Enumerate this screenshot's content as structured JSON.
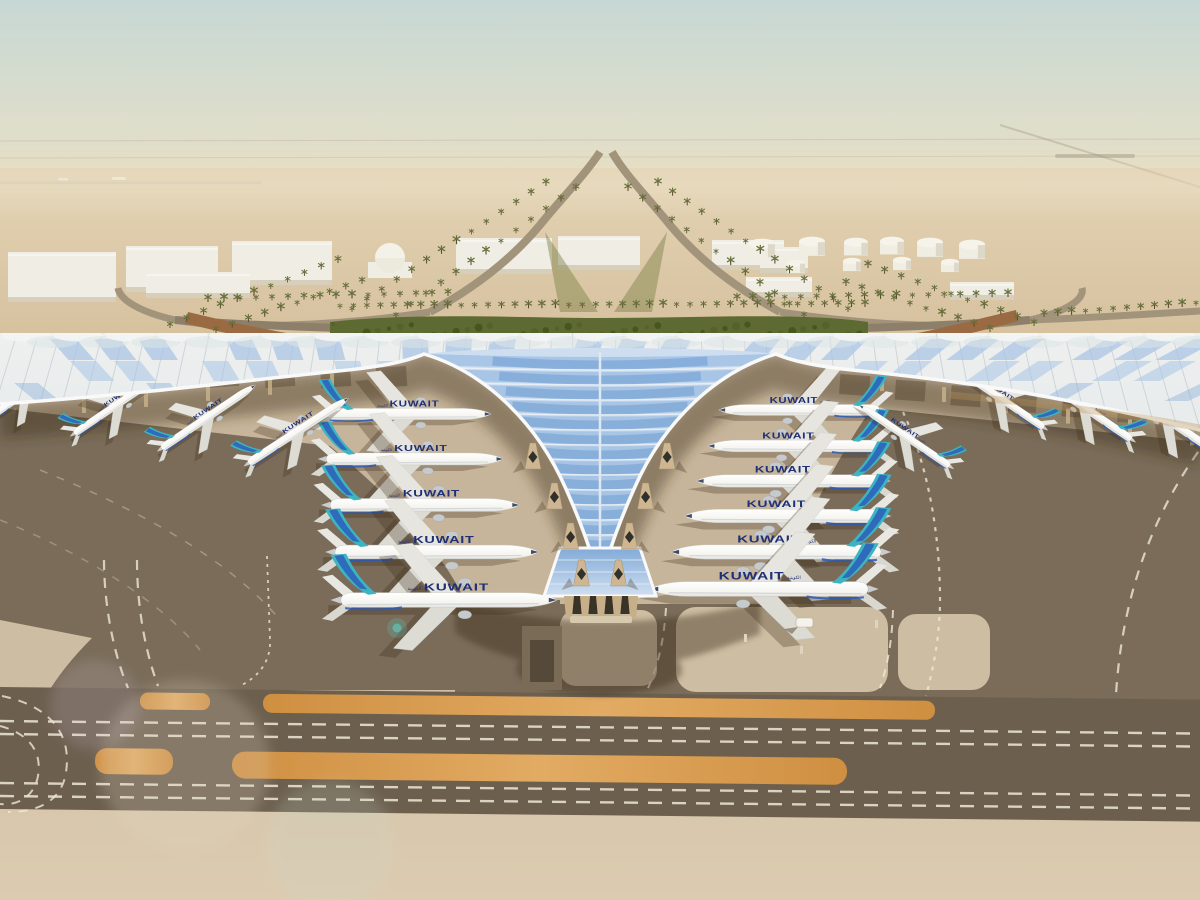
{
  "scene_title": "Aerial rendering of Kuwait International Airport terminal with Kuwait Airways aircraft parked at gates",
  "livery": {
    "title": "KUWAIT",
    "script": "الكويتية"
  },
  "counts": {
    "widebodies_left_pier": 5,
    "widebodies_right_pier": 6,
    "narrowbodies_wings": 7,
    "storage_tanks": 10
  },
  "colors": {
    "sky_top": "#c7d8d4",
    "sky_mid": "#dfdecb",
    "horizon": "#e9dcbf",
    "desert_far": "#e3d3b4",
    "desert_near": "#d5bf9c",
    "haze": "#ece0c6",
    "building": "#efede4",
    "building_shade": "#d6cfbc",
    "tank": "#f0ede2",
    "road": "#a2937b",
    "road_dark": "#8d7f6a",
    "ramp_wall": "#9a6a42",
    "palm": "#65703a",
    "hedge": "#5d6a31",
    "hedge_dark": "#47551f",
    "roof_light": "#eef0ef",
    "roof_shade": "#dde3e6",
    "roof_rib": "#c6ced3",
    "fascia": "#f8f9f8",
    "glass": "#a7c4e5",
    "glass_deep": "#82aad8",
    "glass_pale": "#cfdff0",
    "shadow": "#3e2f1c",
    "apron": "#c7b59b",
    "apron_dark": "#b2a086",
    "asphalt": "#7a6c59",
    "asphalt_dark": "#6c5f4e",
    "island": "#cdbda2",
    "orange1": "#cf8f41",
    "orange2": "#e2ab63",
    "marking": "#efe8d6",
    "concrete": "#d3c3a8",
    "concrete_light": "#dccbb0",
    "fuselage": "#f5f4f0",
    "belly": "#cfd3d6",
    "teal": "#3db4c2",
    "navy": "#2b59b8",
    "title_navy": "#1e3076",
    "column_tan": "#c7b089",
    "pod_tan": "#cdb691"
  },
  "aircraft": {
    "left_pier": [
      {
        "x": 408,
        "y": 414,
        "s": 0.8,
        "rot": 0
      },
      {
        "x": 414,
        "y": 459,
        "s": 0.86,
        "rot": 0
      },
      {
        "x": 424,
        "y": 505,
        "s": 0.92,
        "rot": 0
      },
      {
        "x": 436,
        "y": 552,
        "s": 0.99,
        "rot": 0
      },
      {
        "x": 448,
        "y": 600,
        "s": 1.05,
        "rot": 0
      }
    ],
    "right_pier": [
      {
        "x": 800,
        "y": 410,
        "s": 0.78,
        "rot": 0
      },
      {
        "x": 795,
        "y": 446,
        "s": 0.84,
        "rot": 0
      },
      {
        "x": 790,
        "y": 481,
        "s": 0.9,
        "rot": 0
      },
      {
        "x": 784,
        "y": 516,
        "s": 0.96,
        "rot": 0
      },
      {
        "x": 777,
        "y": 552,
        "s": 1.02,
        "rot": 0
      },
      {
        "x": 760,
        "y": 589,
        "s": 1.06,
        "rot": 0
      }
    ],
    "left_wing": [
      {
        "x": 25,
        "y": 393,
        "s": 0.5,
        "rot": -35
      },
      {
        "x": 118,
        "y": 404,
        "s": 0.52,
        "rot": -34
      },
      {
        "x": 208,
        "y": 417,
        "s": 0.55,
        "rot": -34
      },
      {
        "x": 298,
        "y": 431,
        "s": 0.58,
        "rot": -33
      }
    ],
    "right_wing": [
      {
        "x": 905,
        "y": 436,
        "s": 0.53,
        "rot": 34
      },
      {
        "x": 1000,
        "y": 398,
        "s": 0.52,
        "rot": 34
      },
      {
        "x": 1085,
        "y": 408,
        "s": 0.55,
        "rot": 34
      },
      {
        "x": 1168,
        "y": 420,
        "s": 0.57,
        "rot": 34
      }
    ]
  },
  "palm_rows": [
    {
      "x1": 340,
      "y1": 309,
      "x2": 865,
      "y2": 307,
      "n": 40
    },
    {
      "x1": 352,
      "y1": 312,
      "x2": 546,
      "y2": 186,
      "n": 14
    },
    {
      "x1": 396,
      "y1": 318,
      "x2": 576,
      "y2": 191,
      "n": 13
    },
    {
      "x1": 848,
      "y1": 312,
      "x2": 658,
      "y2": 186,
      "n": 14
    },
    {
      "x1": 804,
      "y1": 318,
      "x2": 628,
      "y2": 191,
      "n": 13
    },
    {
      "x1": 170,
      "y1": 328,
      "x2": 338,
      "y2": 263,
      "n": 11
    },
    {
      "x1": 216,
      "y1": 333,
      "x2": 362,
      "y2": 284,
      "n": 10
    },
    {
      "x1": 1034,
      "y1": 326,
      "x2": 868,
      "y2": 268,
      "n": 11
    },
    {
      "x1": 990,
      "y1": 332,
      "x2": 846,
      "y2": 286,
      "n": 10
    },
    {
      "x1": 1044,
      "y1": 317,
      "x2": 1196,
      "y2": 306,
      "n": 12
    },
    {
      "x1": 737,
      "y1": 301,
      "x2": 1008,
      "y2": 297,
      "n": 18
    },
    {
      "x1": 208,
      "y1": 302,
      "x2": 448,
      "y2": 296,
      "n": 16
    }
  ],
  "tanks": [
    {
      "x": 762,
      "y": 252,
      "r": 13
    },
    {
      "x": 812,
      "y": 250,
      "r": 13
    },
    {
      "x": 856,
      "y": 250,
      "r": 12
    },
    {
      "x": 892,
      "y": 249,
      "r": 12
    },
    {
      "x": 930,
      "y": 251,
      "r": 13
    },
    {
      "x": 972,
      "y": 253,
      "r": 13
    },
    {
      "x": 796,
      "y": 269,
      "r": 9
    },
    {
      "x": 852,
      "y": 267,
      "r": 9
    },
    {
      "x": 902,
      "y": 266,
      "r": 9
    },
    {
      "x": 950,
      "y": 268,
      "r": 9
    }
  ],
  "buildings": [
    {
      "x": 8,
      "y": 252,
      "w": 108,
      "h": 50
    },
    {
      "x": 126,
      "y": 246,
      "w": 92,
      "h": 46
    },
    {
      "x": 232,
      "y": 241,
      "w": 100,
      "h": 44
    },
    {
      "x": 456,
      "y": 238,
      "w": 96,
      "h": 36
    },
    {
      "x": 558,
      "y": 236,
      "w": 82,
      "h": 34
    },
    {
      "x": 712,
      "y": 240,
      "w": 72,
      "h": 30
    },
    {
      "x": 760,
      "y": 247,
      "w": 48,
      "h": 26
    },
    {
      "x": 746,
      "y": 277,
      "w": 66,
      "h": 20
    },
    {
      "x": 950,
      "y": 282,
      "w": 64,
      "h": 18
    },
    {
      "x": 146,
      "y": 272,
      "w": 104,
      "h": 26
    }
  ],
  "dome": {
    "x": 390,
    "y": 258,
    "r": 15
  },
  "gate_pod_rows": [
    455,
    495,
    535,
    572
  ]
}
